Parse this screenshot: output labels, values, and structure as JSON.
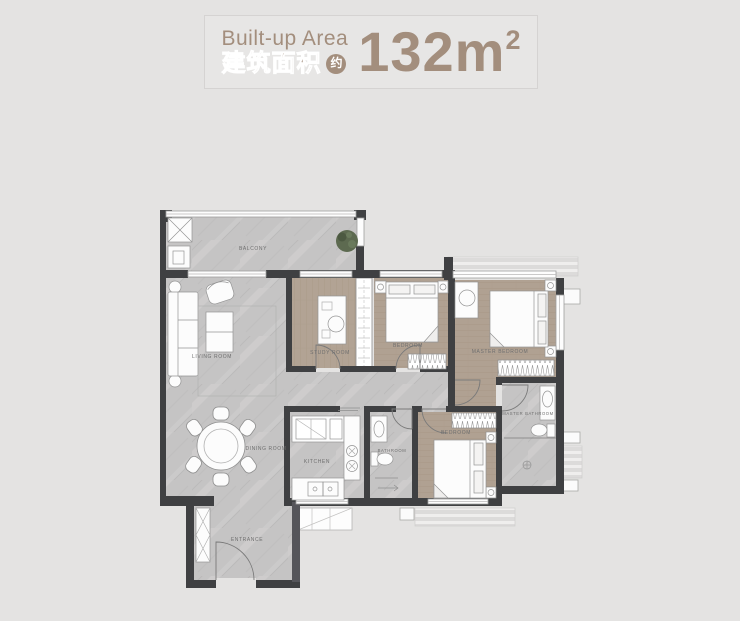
{
  "header": {
    "title_en": "Built-up Area",
    "title_zh": "建筑面积",
    "approx_badge": "约",
    "area_value": "132m",
    "area_sup": "2"
  },
  "floorplan": {
    "rooms": {
      "balcony": "BALCONY",
      "living_room": "LIVING ROOM",
      "dining_room": "DINING ROOM",
      "entrance": "ENTRANCE",
      "study_room": "STUDY ROOM",
      "bedroom_top": "BEDROOM",
      "master_bedroom": "MASTER BEDROOM",
      "master_bathroom": "MASTER BATHROOM",
      "bedroom_bottom": "BEDROOM",
      "bathroom": "BATHROOM",
      "kitchen": "KITCHEN"
    }
  },
  "colors": {
    "accent": "#a38e7d",
    "page_background": "#e4e3e2",
    "wood_floor": "#b0a192",
    "marble_floor": "#c5c4c4",
    "wall": "#3f4042",
    "plant": "#5d6a50"
  }
}
